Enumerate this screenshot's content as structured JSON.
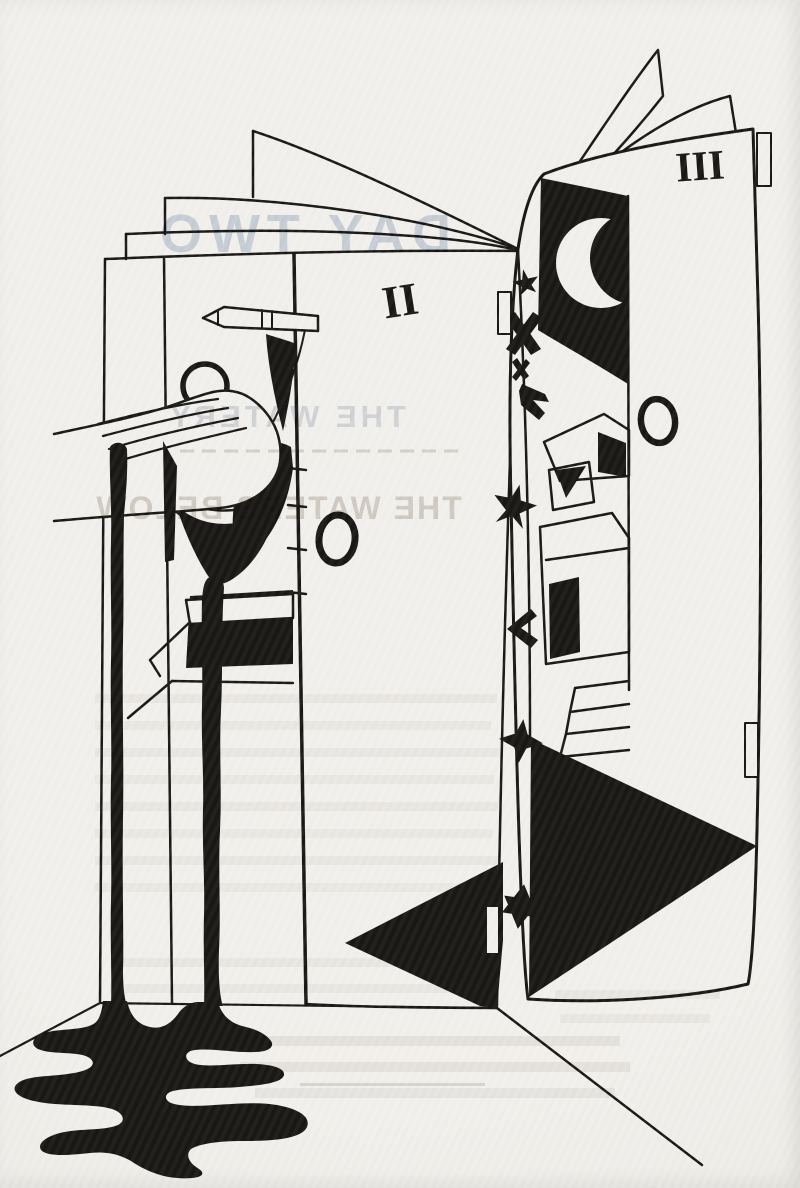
{
  "artwork": {
    "numerals": {
      "middle_door": "II",
      "right_door": "III"
    },
    "ghost_text": {
      "title": "DAY TWO",
      "heading1": "THE WATERY",
      "heading2": "THE WATERS BELOW"
    },
    "colors": {
      "paper": "#f2f0ec",
      "ink": "#1a1815",
      "ghost_blue": "#8fa3c2",
      "ghost_warm": "#a2988a"
    }
  }
}
